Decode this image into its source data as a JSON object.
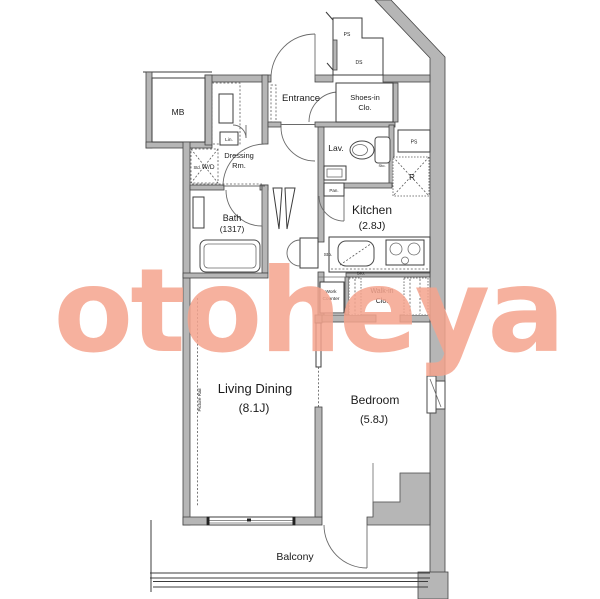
{
  "colors": {
    "bg": "#ffffff",
    "wall": "#b6b6b6",
    "wallEdge": "#454545",
    "line": "#3c3c3c",
    "watermark": "#f5a48e"
  },
  "watermark": {
    "text": "otoheya"
  },
  "rooms": {
    "entrance": "Entrance",
    "shoes_1": "Shoes-in",
    "shoes_2": "Clo.",
    "lav": "Lav.",
    "kitchen": "Kitchen",
    "kitchen_size": "(2.8J)",
    "bath": "Bath",
    "bath_size": "(1317)",
    "dressing_1": "Dressing",
    "dressing_2": "Rm.",
    "living": "Living Dining",
    "living_size": "(8.1J)",
    "bedroom": "Bedroom",
    "bedroom_size": "(5.8J)",
    "balcony": "Balcony",
    "walkin_1": "Walk-in",
    "walkin_2": "Clo.",
    "work_1": "Work",
    "work_2": "Counter"
  },
  "labels": {
    "mb": "MB",
    "ps_top": "PS",
    "ds": "DS",
    "ps_side": "PS",
    "fridge": "R",
    "wd_prefix": "Std.",
    "wd": "W/D",
    "linen": "Lin.",
    "pantry": "Pan.",
    "storage_cabinet": "Sto.",
    "storage_sink": "Sto.",
    "storage_lav": "Sto.",
    "picture_rail": "Picture Rail"
  }
}
